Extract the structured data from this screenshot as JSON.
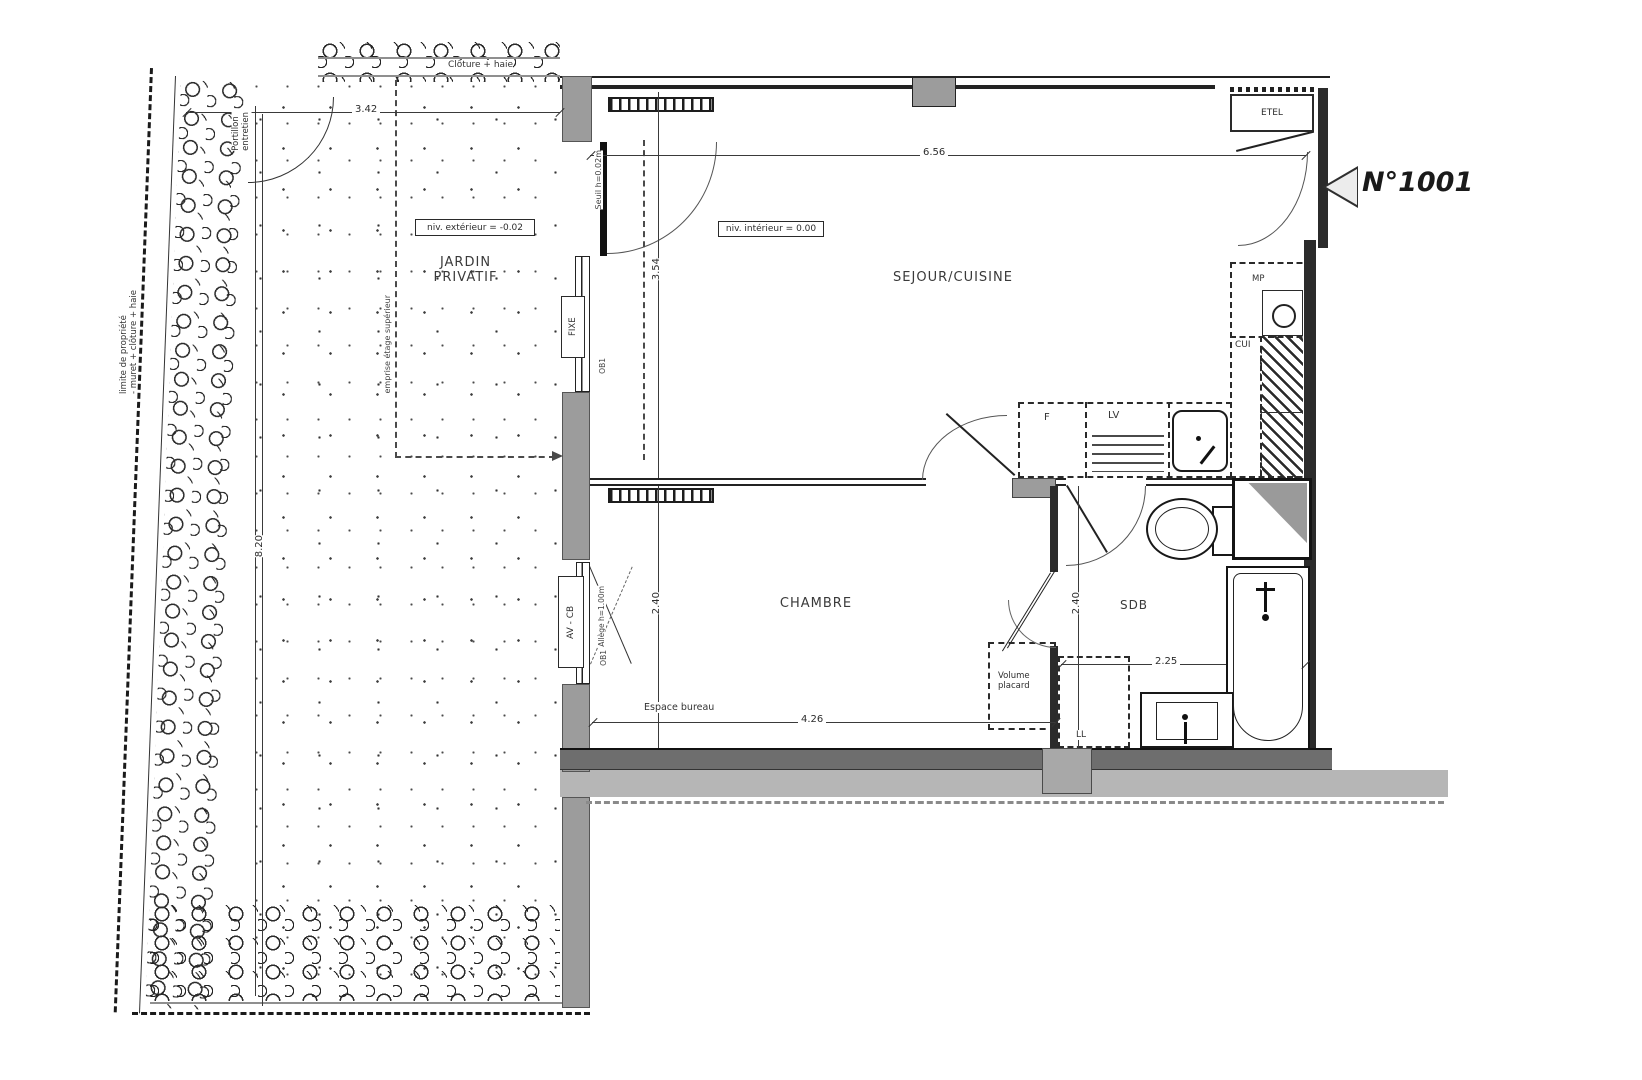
{
  "plan": {
    "unit_number": "N°1001",
    "rooms": {
      "jardin": "JARDIN\nPRIVATIF",
      "sejour": "SEJOUR/CUISINE",
      "chambre": "CHAMBRE",
      "sdb": "SDB"
    },
    "dimensions": {
      "garden_width": "3.42",
      "garden_length": "8.20",
      "sejour_width": "6.56",
      "sejour_depth": "3.54",
      "chambre_depth": "2.40",
      "chambre_width": "4.26",
      "sdb_depth": "2.40",
      "sdb_width": "2.25"
    },
    "levels": {
      "exterior": "niv. extérieur = -0.02",
      "interior": "niv. intérieur = 0.00"
    },
    "annotations": {
      "cloture_haie": "Clôture + haie",
      "portillon": "Portillon\nentretien",
      "limite_propriete": "limite de propriété\n- muret + clôture + haie",
      "emprise": "emprise étage supérieur",
      "seuil": "Seuil h=0.02m",
      "fixe": "FIXE",
      "av_cb": "AV - CB",
      "allege": "Allège h=1.00m",
      "ob": "OB1",
      "espace_bureau": "Espace bureau",
      "volume_placard": "Volume\nplacard"
    },
    "equipment": {
      "etel": "ETEL",
      "mp": "MP",
      "ch": "CH",
      "cui": "CUI",
      "f": "F",
      "lv": "LV",
      "ll": "LL"
    },
    "colors": {
      "wall_dark": "#2b2b2b",
      "wall_gray": "#9c9c9c",
      "band_light": "#b6b6b6",
      "line": "#1c1c1c"
    }
  }
}
